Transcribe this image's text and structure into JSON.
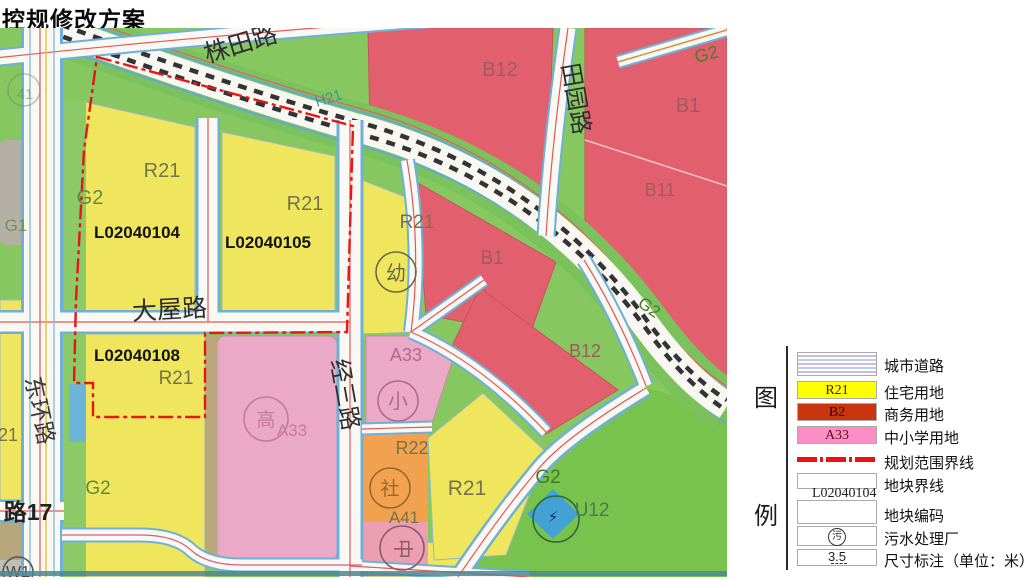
{
  "title": "控规修改方案",
  "map": {
    "roads": {
      "zhutian": "株田路",
      "tianyuan": "田园路",
      "dawu": "大屋路",
      "donghuan": "东环路",
      "jingsan": "经三路",
      "lu17": "路17"
    },
    "labels": {
      "h21": "H21",
      "g2": "G2",
      "g1": "G1",
      "r21": "R21",
      "r22": "R22",
      "a33": "A33",
      "a41": "A41",
      "b1": "B1",
      "b11": "B11",
      "b12": "B12",
      "u12": "U12",
      "w1": "W1",
      "num41": "41",
      "num21": "21",
      "code104": "L02040104",
      "code105": "L02040105",
      "code108": "L02040108",
      "kindergarten": "幼",
      "primary": "小",
      "community": "社",
      "highschool": "高",
      "mid_glyph": "中",
      "bolt": "⚡"
    },
    "palette": {
      "yellow": "#f0e65e",
      "red": "#e2606e",
      "pink": "#e9a9c7",
      "green_bg": "#87c75f",
      "green_g2": "#78c24e",
      "orange": "#f2a24e",
      "rail_green": "#7cc25c",
      "road_blue": "#6fb0d8",
      "boundary_red": "#e81515"
    }
  },
  "legend": {
    "title_top": "图",
    "title_bottom": "例",
    "items": [
      {
        "code": "",
        "label": "城市道路"
      },
      {
        "code": "R21",
        "label": "住宅用地",
        "color": "#ffff00"
      },
      {
        "code": "B2",
        "label": "商务用地",
        "color": "#c8350f"
      },
      {
        "code": "A33",
        "label": "中小学用地",
        "color": "#fb8ec4"
      },
      {
        "code": "",
        "label": "规划范围界线"
      },
      {
        "code": "",
        "label": "地块界线",
        "example": "L02040104"
      },
      {
        "code": "",
        "label": "地块编码"
      },
      {
        "code": "污",
        "label": "污水处理厂"
      },
      {
        "code": "3.5",
        "label": "尺寸标注（单位：米）"
      }
    ]
  }
}
